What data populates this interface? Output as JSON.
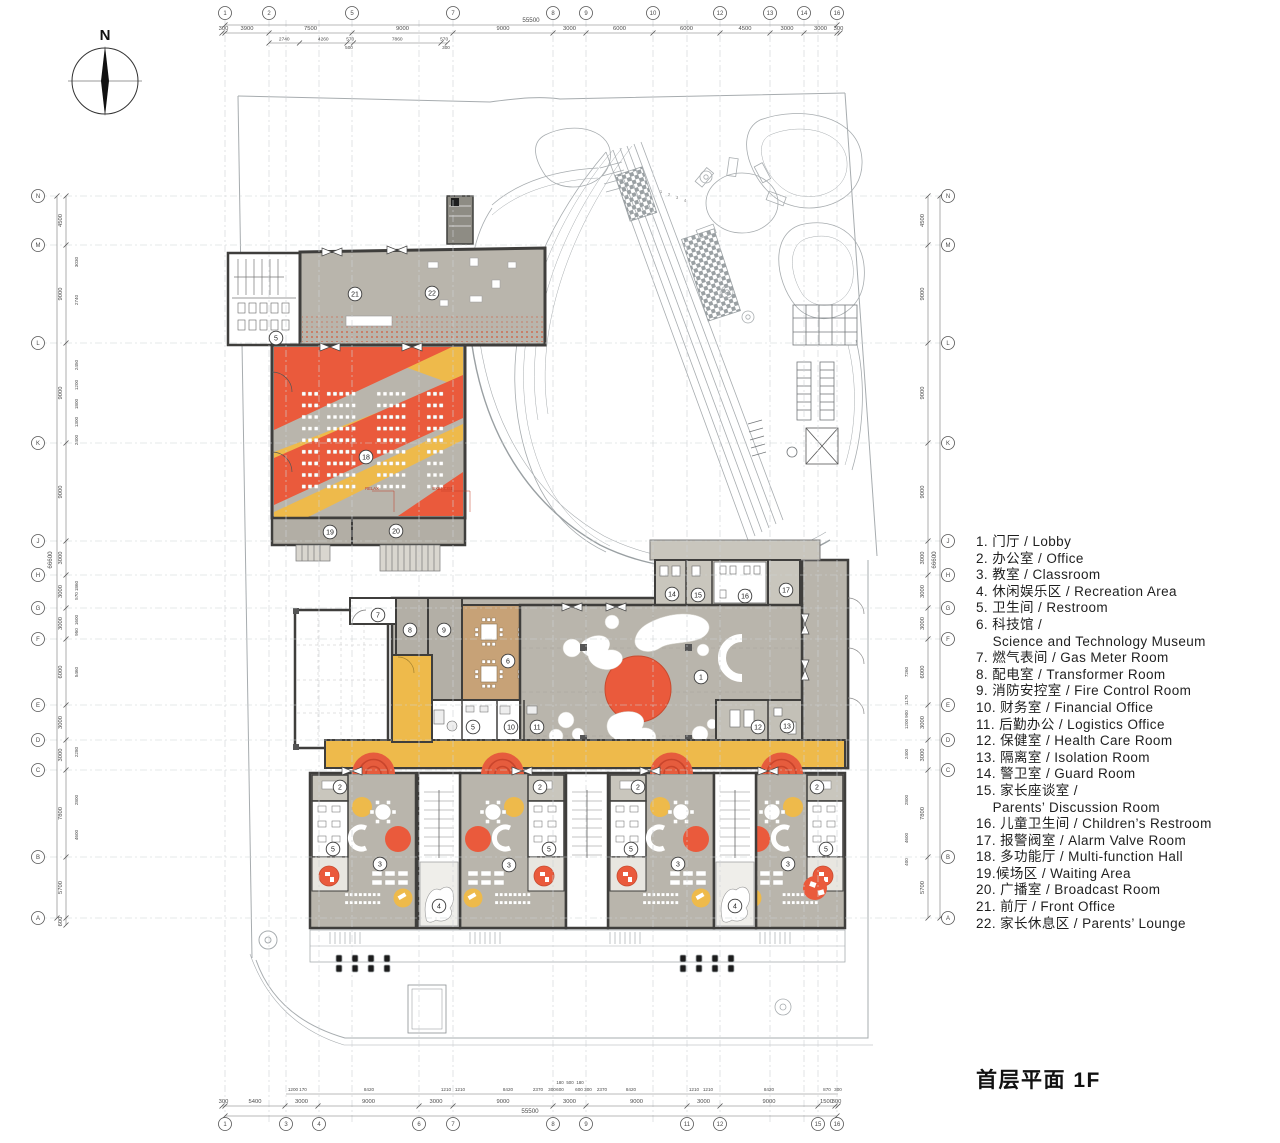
{
  "page": {
    "title": "首层平面 1F",
    "north_label": "N"
  },
  "legend": {
    "lines": [
      "1. 门厅 / Lobby",
      "2. 办公室 / Office",
      "3. 教室 / Classroom",
      "4. 休闲娱乐区 / Recreation Area",
      "5. 卫生间 / Restroom",
      "6. 科技馆 /",
      "    Science and Technology Museum",
      "7. 燃气表间 / Gas Meter Room",
      "8. 配电室 / Transformer Room",
      "9. 消防安控室 / Fire Control Room",
      "10. 财务室 / Financial Office",
      "11. 后勤办公 / Logistics Office",
      "12. 保健室 / Health Care Room",
      "13. 隔离室 / Isolation Room",
      "14. 警卫室 / Guard Room",
      "15. 家长座谈室 /",
      "    Parents’ Discussion Room",
      "16. 儿童卫生间 / Children’s Restroom",
      "17. 报警阀室 / Alarm Valve Room",
      "18. 多功能厅 / Multi-function Hall",
      "19.候场区 / Waiting Area",
      "20. 广播室 / Broadcast Room",
      "21. 前厅 / Front Office",
      "22. 家长休息区 / Parents’ Lounge"
    ]
  },
  "grid": {
    "top": [
      "1",
      "2",
      "5",
      "7",
      "8",
      "9",
      "10",
      "12",
      "13",
      "14",
      "16"
    ],
    "bottom": [
      "1",
      "3",
      "4",
      "6",
      "7",
      "8",
      "9",
      "11",
      "12",
      "15",
      "16"
    ],
    "left": [
      "N",
      "M",
      "L",
      "K",
      "J",
      "H",
      "G",
      "F",
      "E",
      "D",
      "C",
      "B",
      "A"
    ],
    "right": [
      "N",
      "M",
      "L",
      "K",
      "J",
      "H",
      "G",
      "F",
      "E",
      "D",
      "C",
      "B",
      "A"
    ]
  },
  "dims": {
    "top": {
      "total": "55500",
      "main": [
        "300",
        "3900",
        "7500",
        "9000",
        "9000",
        "3000",
        "6000",
        "6000",
        "4500",
        "3000",
        "3000",
        "300"
      ],
      "sub": [
        "2740",
        "4260",
        "570",
        "7860",
        "570"
      ],
      "sub2": [
        "500",
        "300"
      ]
    },
    "bottom": {
      "total": "55500",
      "main": [
        "300",
        "5400",
        "3000",
        "9000",
        "3000",
        "9000",
        "3000",
        "9000",
        "3000",
        "9000",
        "1500",
        "300"
      ],
      "sub": [
        "1200",
        "170",
        "8420",
        "1210",
        "1210",
        "8420",
        "2370",
        "300",
        "600",
        "600",
        "300",
        "2370",
        "8420",
        "1210",
        "1210",
        "8420",
        "870",
        "300"
      ],
      "sub2": [
        "180",
        "500",
        "180"
      ]
    },
    "left": {
      "total": "66600",
      "main": [
        "4500",
        "9000",
        "9000",
        "9000",
        "3000",
        "3000",
        "3000",
        "6000",
        "3000",
        "3000",
        "7800",
        "5700",
        "600"
      ],
      "sub": [
        "3030",
        "2740",
        "2450",
        "1200",
        "1800",
        "1300",
        "2400",
        "1860",
        "570",
        "1600",
        "950",
        "5460",
        "2280",
        "2800",
        "4600"
      ]
    },
    "right": {
      "total": "66600",
      "main": [
        "4500",
        "9000",
        "9000",
        "9000",
        "3000",
        "3000",
        "3000",
        "6000",
        "3000",
        "3000",
        "7800",
        "5700"
      ],
      "sub": [
        "7260",
        "1170",
        "900",
        "1200",
        "2400",
        "2800",
        "4600",
        "400"
      ]
    }
  },
  "plan": {
    "room_labels": [
      {
        "n": "21",
        "x": 355,
        "y": 294
      },
      {
        "n": "22",
        "x": 432,
        "y": 293
      },
      {
        "n": "5",
        "x": 276,
        "y": 338
      },
      {
        "n": "18",
        "x": 366,
        "y": 457
      },
      {
        "n": "19",
        "x": 330,
        "y": 532
      },
      {
        "n": "20",
        "x": 396,
        "y": 531
      },
      {
        "n": "7",
        "x": 378,
        "y": 615
      },
      {
        "n": "8",
        "x": 410,
        "y": 630
      },
      {
        "n": "9",
        "x": 444,
        "y": 630
      },
      {
        "n": "6",
        "x": 508,
        "y": 661
      },
      {
        "n": "1",
        "x": 701,
        "y": 677
      },
      {
        "n": "5",
        "x": 473,
        "y": 727
      },
      {
        "n": "10",
        "x": 511,
        "y": 727
      },
      {
        "n": "11",
        "x": 537,
        "y": 727
      },
      {
        "n": "14",
        "x": 672,
        "y": 594
      },
      {
        "n": "15",
        "x": 698,
        "y": 595
      },
      {
        "n": "16",
        "x": 745,
        "y": 596
      },
      {
        "n": "17",
        "x": 786,
        "y": 590
      },
      {
        "n": "12",
        "x": 758,
        "y": 727
      },
      {
        "n": "13",
        "x": 787,
        "y": 726
      },
      {
        "n": "2",
        "x": 340,
        "y": 787
      },
      {
        "n": "5",
        "x": 333,
        "y": 849
      },
      {
        "n": "3",
        "x": 380,
        "y": 864
      },
      {
        "n": "2",
        "x": 540,
        "y": 787
      },
      {
        "n": "5",
        "x": 549,
        "y": 849
      },
      {
        "n": "3",
        "x": 509,
        "y": 865
      },
      {
        "n": "4",
        "x": 439,
        "y": 906
      },
      {
        "n": "2",
        "x": 638,
        "y": 787
      },
      {
        "n": "5",
        "x": 631,
        "y": 849
      },
      {
        "n": "3",
        "x": 678,
        "y": 864
      },
      {
        "n": "4",
        "x": 735,
        "y": 906
      },
      {
        "n": "2",
        "x": 817,
        "y": 787
      },
      {
        "n": "5",
        "x": 826,
        "y": 849
      },
      {
        "n": "3",
        "x": 788,
        "y": 864
      }
    ],
    "stage_labels": [
      "RELAX",
      "EXERCISE"
    ],
    "lane_numbers": [
      "1",
      "2",
      "3",
      "4"
    ]
  },
  "colors": {
    "orange": "#ea5a3c",
    "yellow": "#eeba4b",
    "floor_gray": "#b9b5ac",
    "wood": "#c7a277",
    "wall": "#3f3e3c"
  }
}
